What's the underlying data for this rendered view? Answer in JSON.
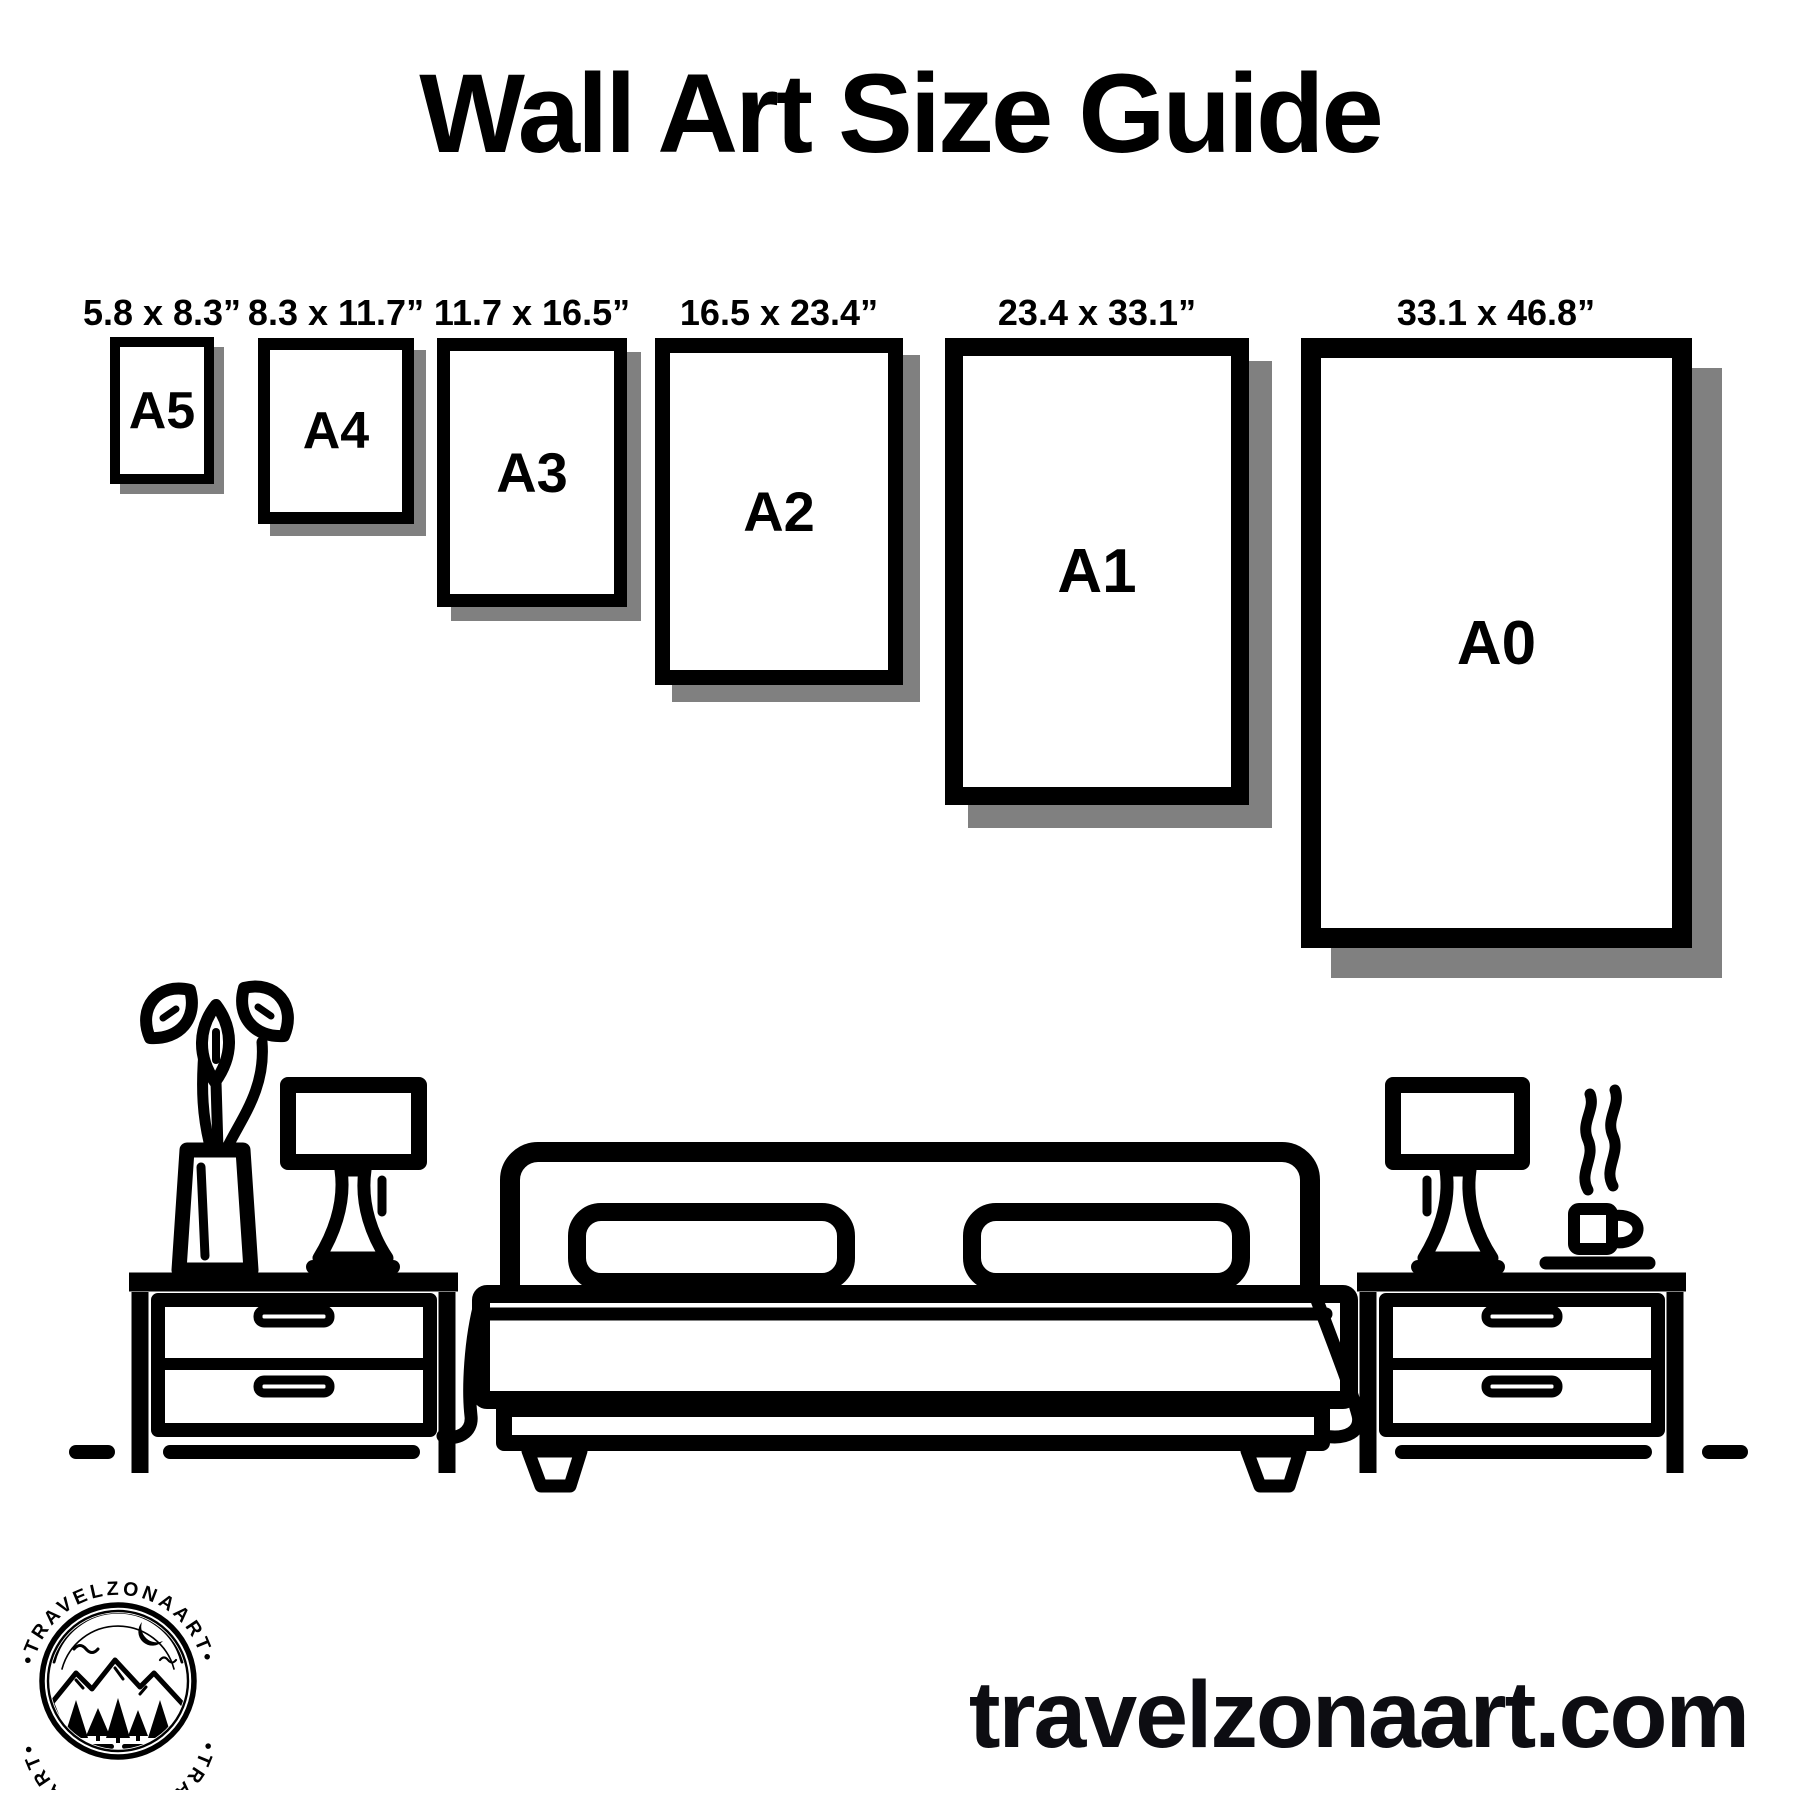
{
  "title": "Wall Art Size Guide",
  "sizes": [
    {
      "name": "A5",
      "dimensions": "5.8 x 8.3”"
    },
    {
      "name": "A4",
      "dimensions": "8.3 x 11.7”"
    },
    {
      "name": "A3",
      "dimensions": "11.7 x 16.5”"
    },
    {
      "name": "A2",
      "dimensions": "16.5 x 23.4”"
    },
    {
      "name": "A1",
      "dimensions": "23.4 x 33.1”"
    },
    {
      "name": "A0",
      "dimensions": "33.1 x 46.8”"
    }
  ],
  "logo": {
    "arc_text_top": "•TRAVELZONAART•",
    "arc_text_bottom": "•TRAVELZONAART•"
  },
  "website": "travelzonaart.com",
  "colors": {
    "ink": "#000000",
    "shadow": "#808080",
    "background": "#ffffff",
    "url_text": "#0d0d12"
  }
}
